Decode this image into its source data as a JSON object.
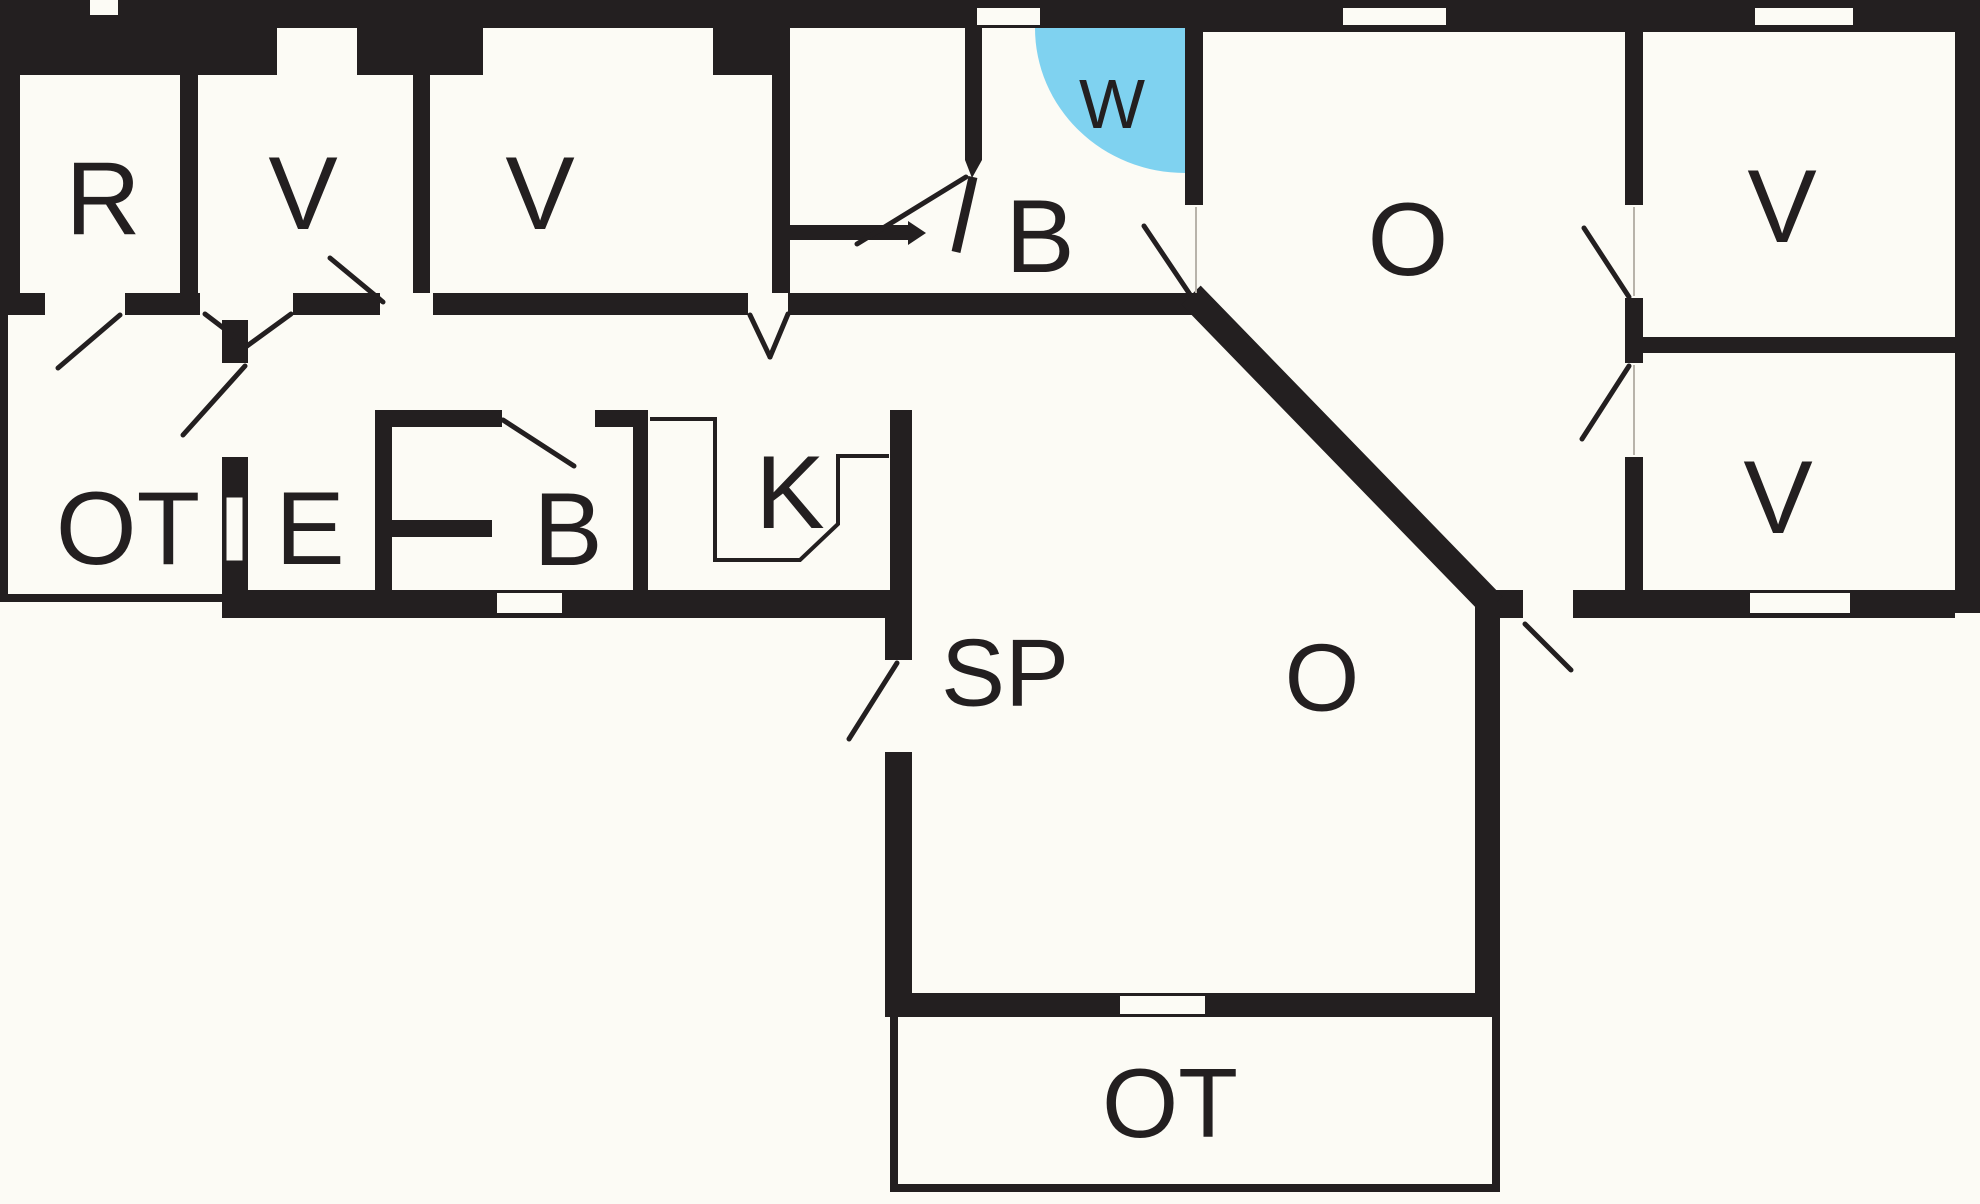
{
  "title": "Floor plan",
  "colors": {
    "wall": "#231F20",
    "floor": "#FCFBF5",
    "water": "#7FD2F0",
    "label": "#231F20"
  },
  "rooms": [
    {
      "id": "r",
      "label": "R"
    },
    {
      "id": "v1",
      "label": "V"
    },
    {
      "id": "v2",
      "label": "V"
    },
    {
      "id": "b1",
      "label": "B"
    },
    {
      "id": "w",
      "label": "W"
    },
    {
      "id": "o1",
      "label": "O"
    },
    {
      "id": "v3",
      "label": "V"
    },
    {
      "id": "v4",
      "label": "V"
    },
    {
      "id": "ot1",
      "label": "OT"
    },
    {
      "id": "e",
      "label": "E"
    },
    {
      "id": "b2",
      "label": "B"
    },
    {
      "id": "k",
      "label": "K"
    },
    {
      "id": "sp",
      "label": "SP"
    },
    {
      "id": "o2",
      "label": "O"
    },
    {
      "id": "ot2",
      "label": "OT"
    }
  ]
}
